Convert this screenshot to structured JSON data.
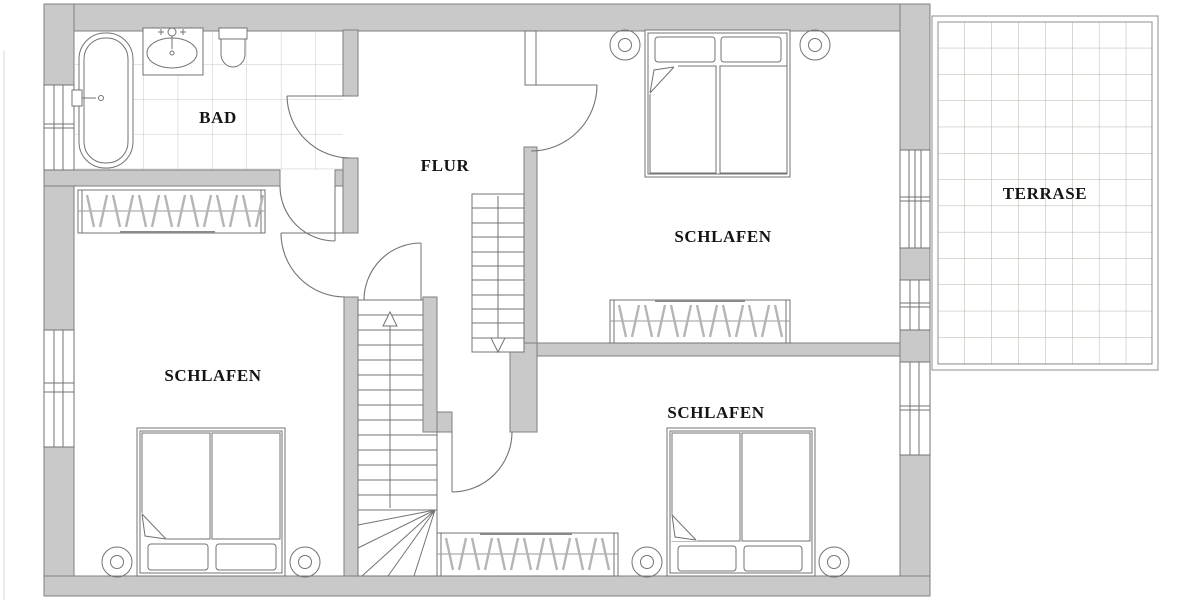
{
  "plan": {
    "title": "floor-plan",
    "rooms": {
      "bathroom": {
        "label": "BAD"
      },
      "hallway": {
        "label": "FLUR"
      },
      "bedroom_top_right": {
        "label": "SCHLAFEN"
      },
      "bedroom_bottom_left": {
        "label": "SCHLAFEN"
      },
      "bedroom_bottom_right": {
        "label": "SCHLAFEN"
      },
      "terrace": {
        "label": "TERRASE"
      }
    },
    "fixtures": [
      "bathtub-icon",
      "washbasin-icon",
      "toilet-icon",
      "double-bed-icon",
      "pillow-icon",
      "nightstand-icon",
      "wardrobe-hangers-icon",
      "stairs-up-icon",
      "stairs-down-icon",
      "door-swing-icon",
      "window-icon",
      "terrace-tiles-icon"
    ],
    "colors": {
      "background": "#ffffff",
      "wall_fill": "#c9c9c9",
      "wall_stroke": "#7f7f7f",
      "line": "#737373",
      "line_light": "#9a9a9a",
      "hanger": "#b5b5b5",
      "tile_grid": "#c8c8c8",
      "terrace_grid": "#b7b0a8",
      "text": "#141414"
    }
  }
}
